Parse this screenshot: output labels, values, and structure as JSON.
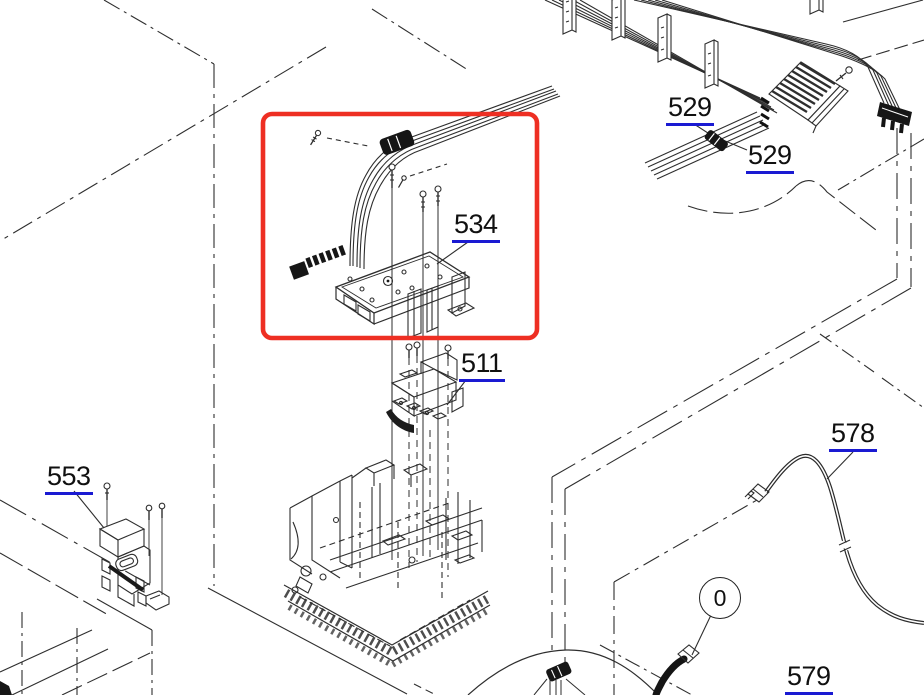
{
  "diagram": {
    "kind": "printer-exploded-parts-diagram",
    "highlighted_part": "534",
    "visible_part_numbers": [
      "529",
      "529",
      "534",
      "511",
      "553",
      "578",
      "579"
    ],
    "callout_badge": "0"
  },
  "labels": {
    "k529a": {
      "text": "529"
    },
    "k529b": {
      "text": "529"
    },
    "k534": {
      "text": "534"
    },
    "k511": {
      "text": "511"
    },
    "k553": {
      "text": "553"
    },
    "k578": {
      "text": "578"
    },
    "k579": {
      "text": "579"
    },
    "zero": {
      "text": "0"
    }
  },
  "colors": {
    "highlight-red": "#ee2f23",
    "link-blue": "#1a1ad2",
    "line-dark": "#2e2e2e"
  }
}
